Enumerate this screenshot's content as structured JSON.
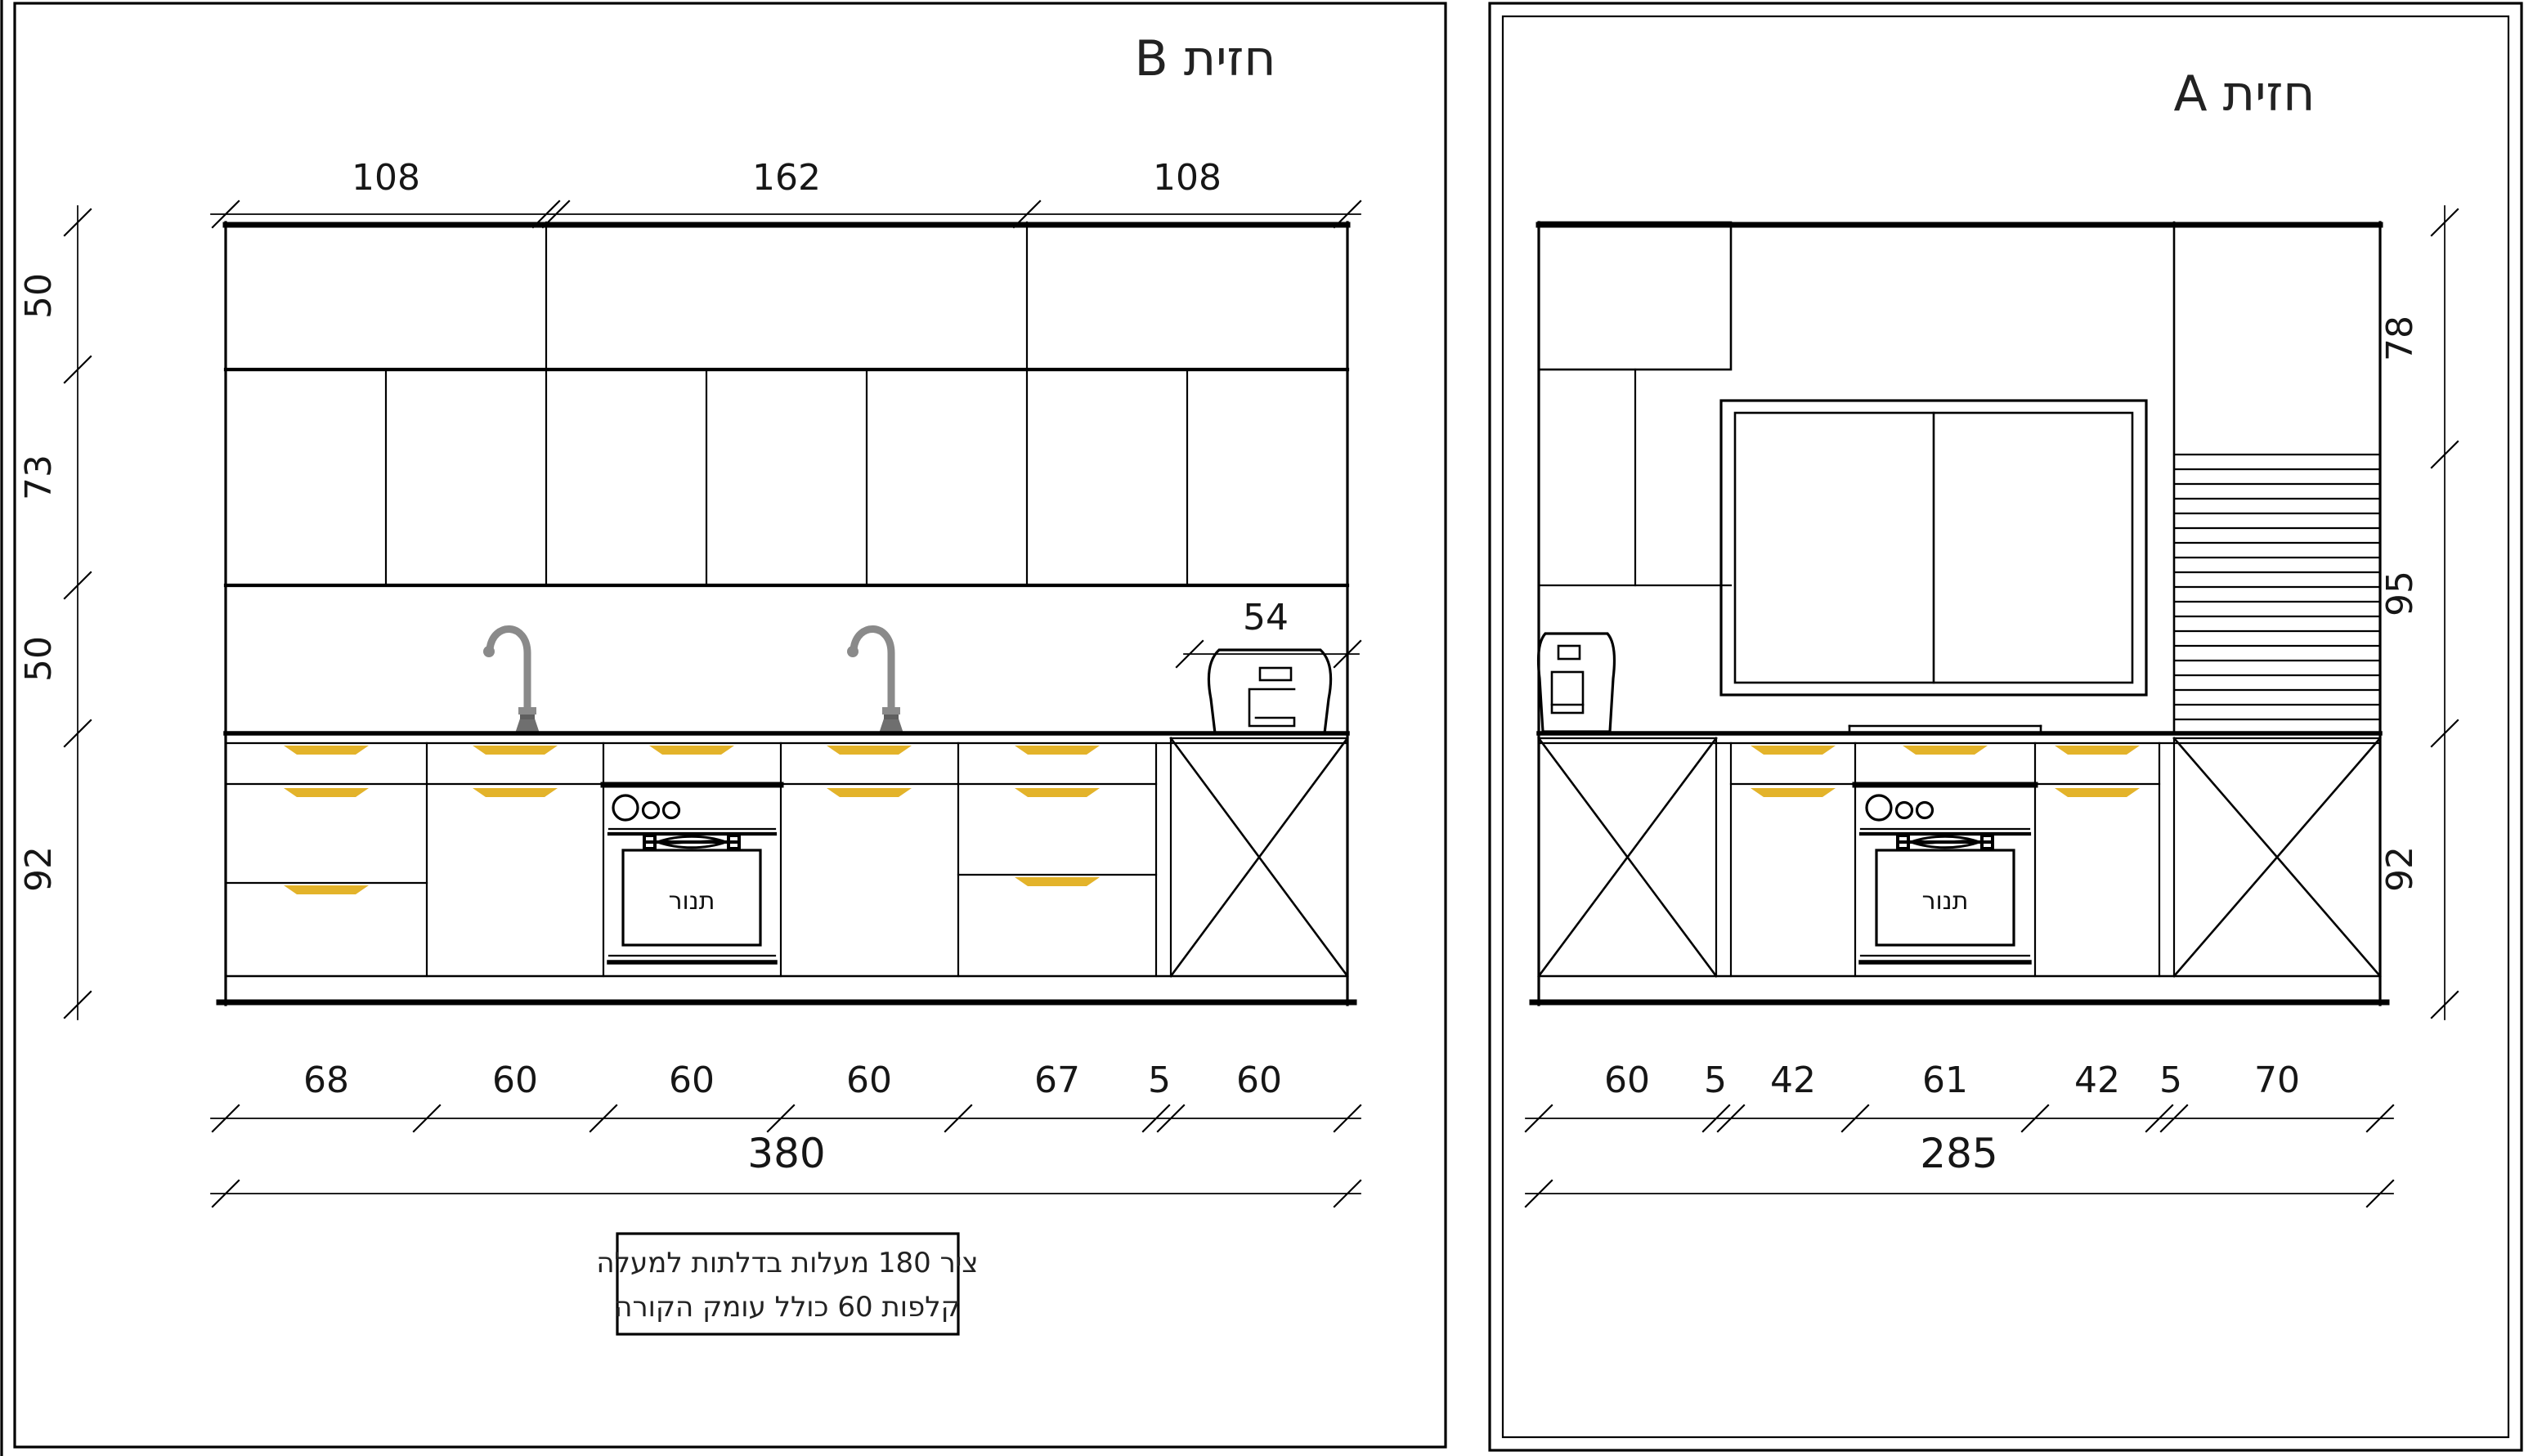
{
  "left_view": {
    "title": "חזית  B",
    "dims_top": [
      "108",
      "162",
      "108"
    ],
    "dims_left": [
      "50",
      "73",
      "50",
      "92"
    ],
    "dims_bottom": [
      "68",
      "60",
      "60",
      "60",
      "67",
      "5",
      "60"
    ],
    "dim_total": "380",
    "dim_54": "54",
    "oven_label": "תנור",
    "note_line1": "ציר 180 מעלות בדלתות למעלה",
    "note_line2": "קלפות 60 כולל עומק הקורה"
  },
  "right_view": {
    "title": "חזית  A",
    "dims_right": [
      "78",
      "95",
      "92"
    ],
    "dims_bottom": [
      "60",
      "5",
      "42",
      "61",
      "42",
      "5",
      "70"
    ],
    "dim_total": "285",
    "oven_label": "תנור"
  },
  "colors": {
    "handle_gold": "#E3B32A",
    "faucet_gray": "#8a8a8a",
    "line_black": "#000000"
  }
}
